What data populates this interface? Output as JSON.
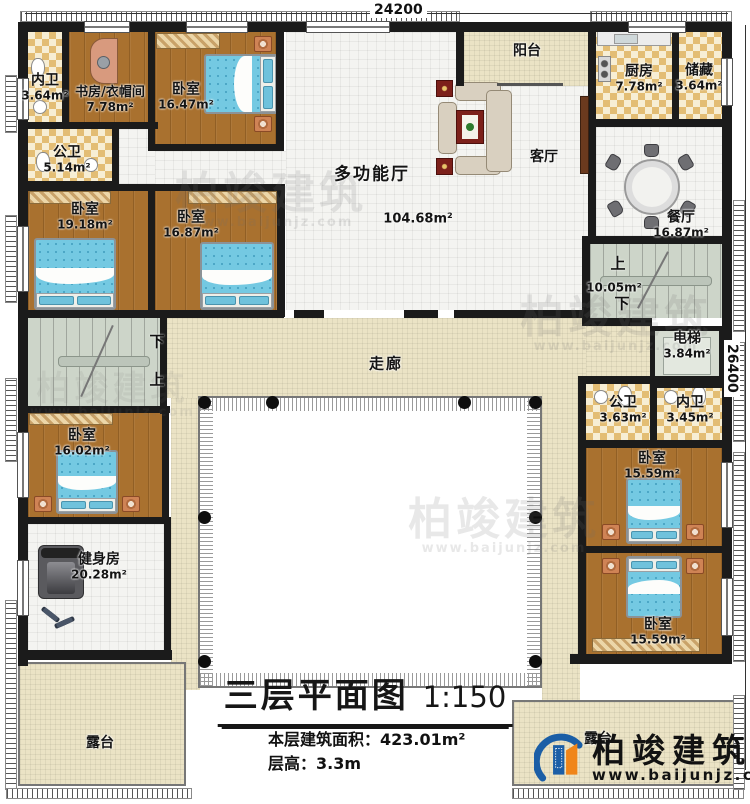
{
  "meta": {
    "dim_top": "24200",
    "dim_right": "26400"
  },
  "title": {
    "text": "三层平面图",
    "scale": "1:150",
    "area_line": "本层建筑面积：423.01m²",
    "height_line": "层高：3.3m"
  },
  "logo": {
    "name": "柏竣建筑",
    "url": "www.baijunjz.com"
  },
  "watermark": {
    "name": "柏竣建筑",
    "url": "www.baijunjz.com"
  },
  "stairs": {
    "up": "上",
    "down": "下",
    "right_area": "10.05m²"
  },
  "rooms": {
    "neiwei_tl": {
      "name": "内卫",
      "area": "3.64m²"
    },
    "study": {
      "name": "书房/衣帽间",
      "area": "7.78m²"
    },
    "bed_top": {
      "name": "卧室",
      "area": "16.47m²"
    },
    "gongwei_tl": {
      "name": "公卫",
      "area": "5.14m²"
    },
    "bed_left1": {
      "name": "卧室",
      "area": "19.18m²"
    },
    "bed_left2": {
      "name": "卧室",
      "area": "16.87m²"
    },
    "hall": {
      "name": "多功能厅",
      "area": "104.68m²"
    },
    "balcony": {
      "name": "阳台"
    },
    "living": {
      "name": "客厅"
    },
    "kitchen": {
      "name": "厨房",
      "area": "7.78m²"
    },
    "storage": {
      "name": "储藏",
      "area": "3.64m²"
    },
    "dining": {
      "name": "餐厅",
      "area": "16.87m²"
    },
    "elevator": {
      "name": "电梯",
      "area": "3.84m²"
    },
    "gongwei_r": {
      "name": "公卫",
      "area": "3.63m²"
    },
    "neiwei_r": {
      "name": "内卫",
      "area": "3.45m²"
    },
    "bed_right1": {
      "name": "卧室",
      "area": "15.59m²"
    },
    "bed_right2": {
      "name": "卧室",
      "area": "15.59m²"
    },
    "corridor": {
      "name": "走廊"
    },
    "bed_bl": {
      "name": "卧室",
      "area": "16.02m²"
    },
    "gym": {
      "name": "健身房",
      "area": "20.28m²"
    },
    "terrace_left": {
      "name": "露台"
    },
    "terrace_right": {
      "name": "露台"
    }
  }
}
